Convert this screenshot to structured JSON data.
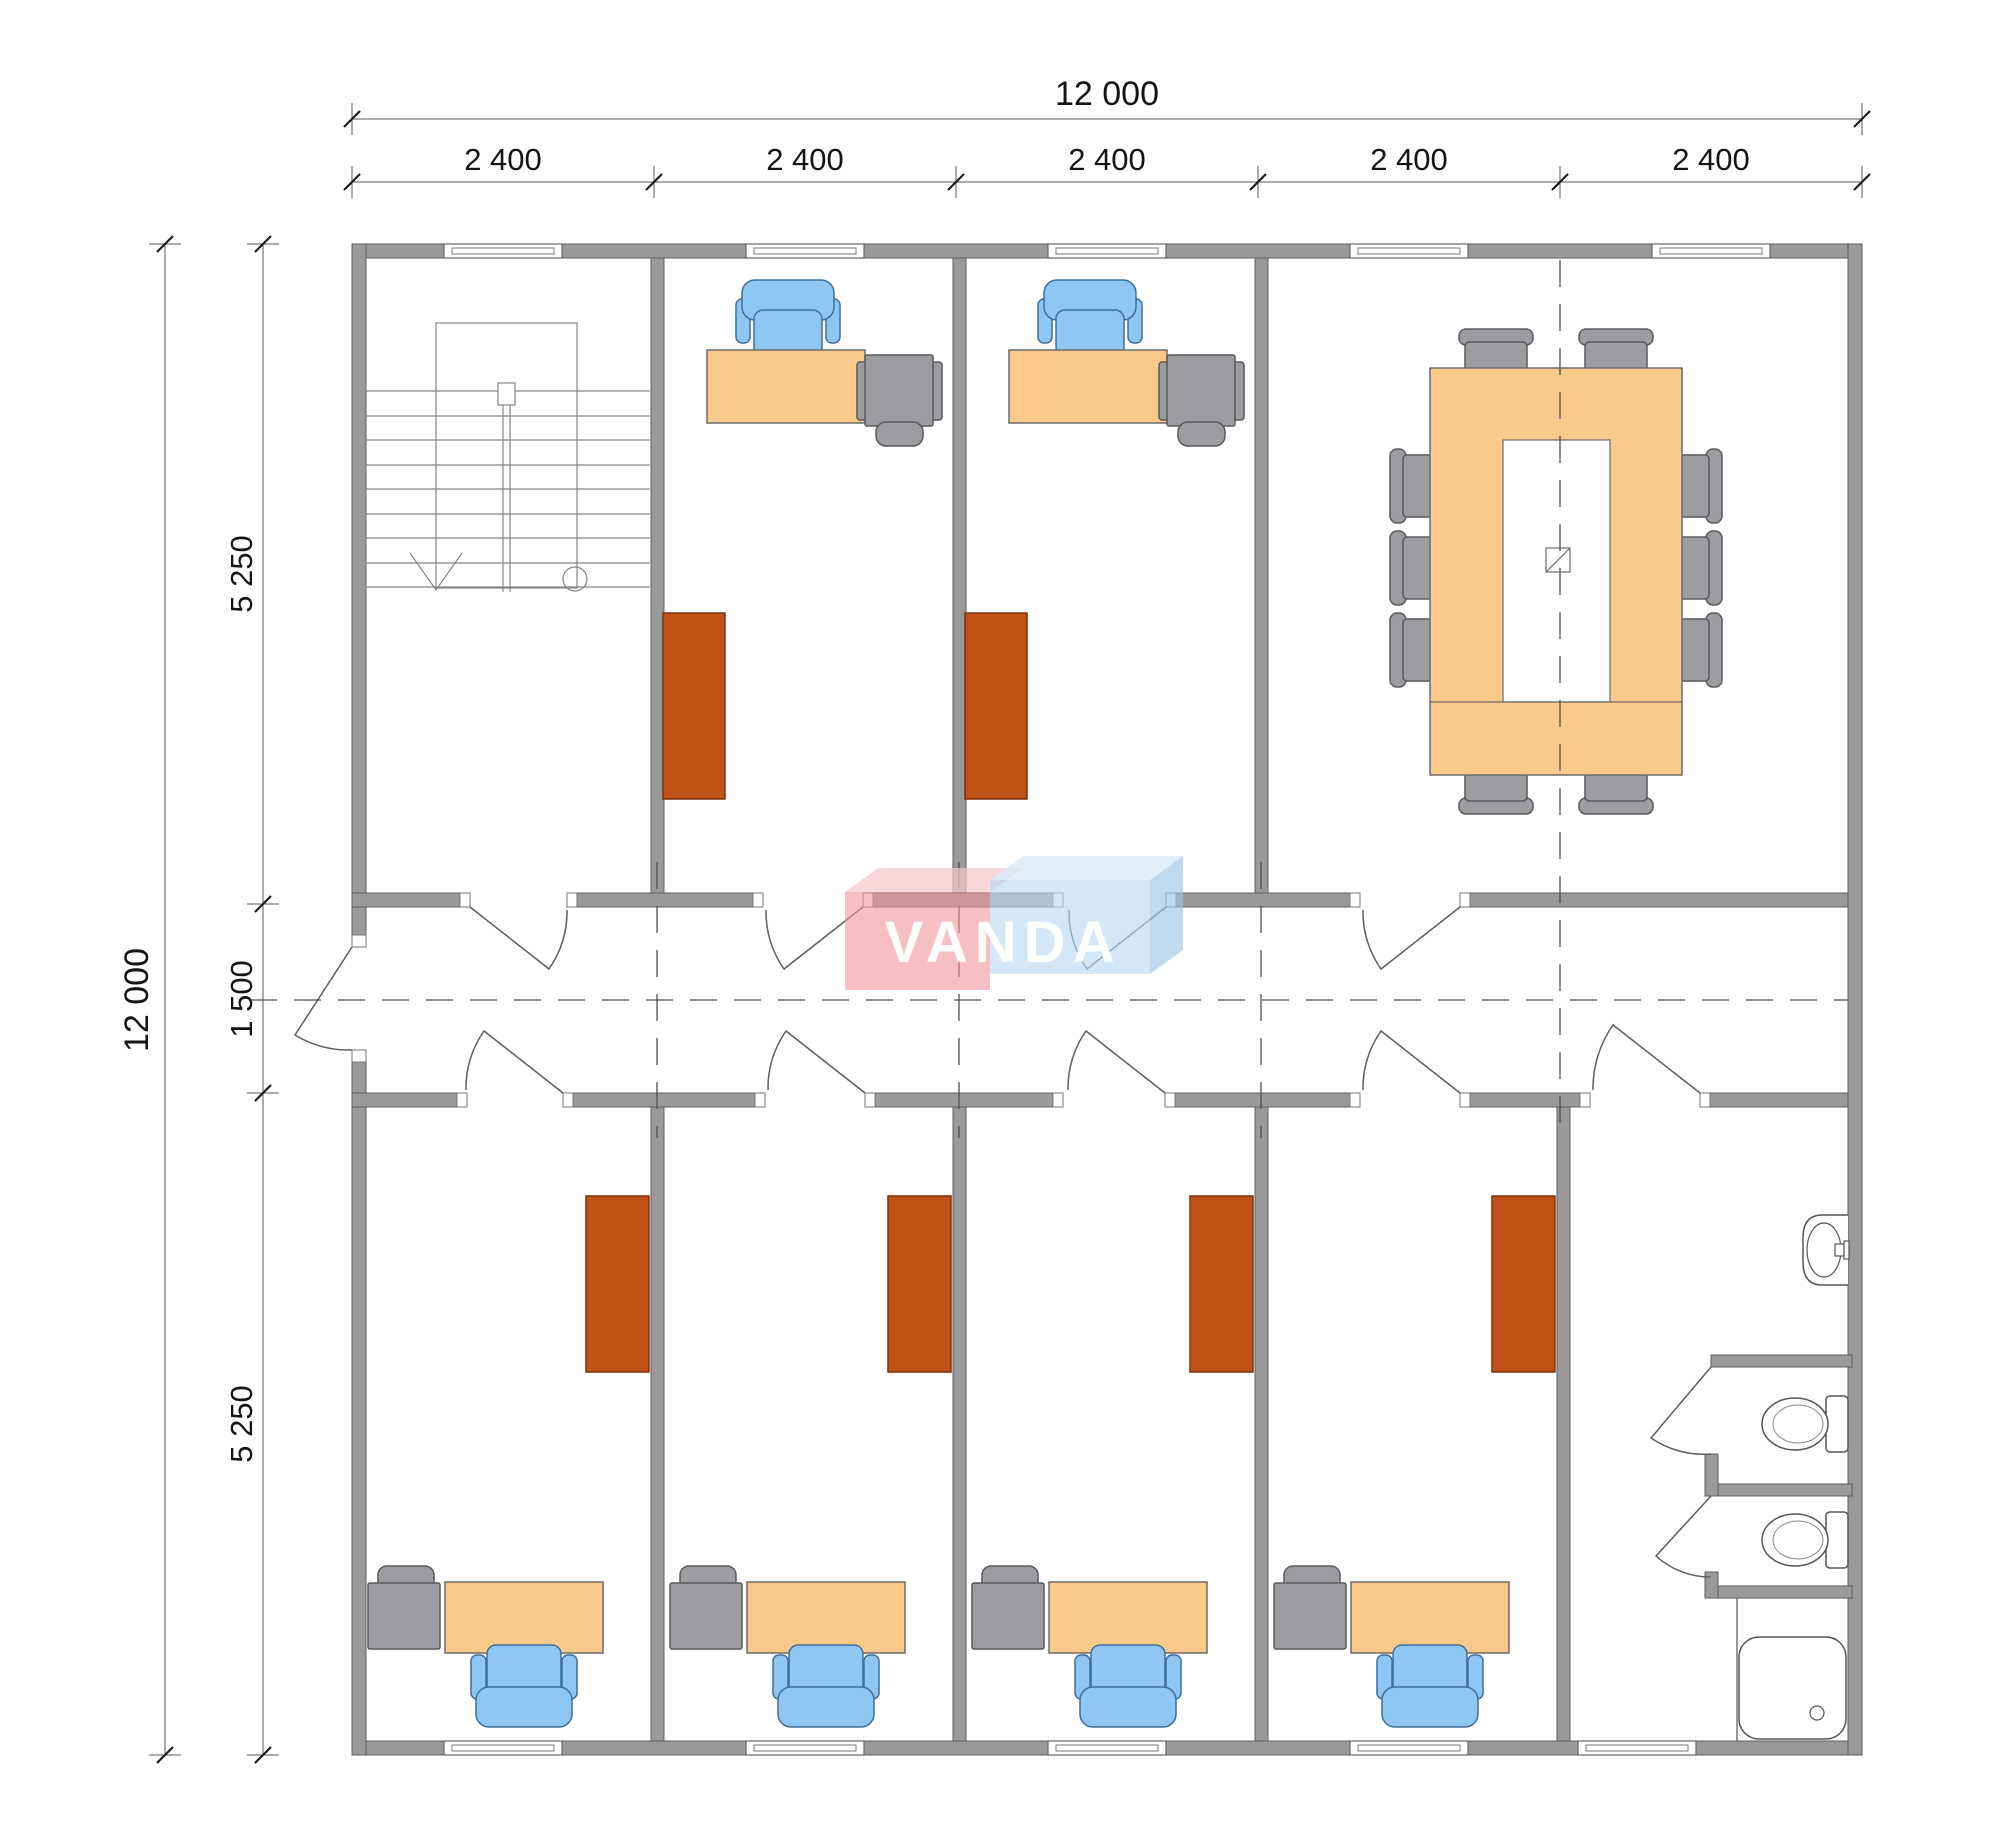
{
  "dimensions": {
    "top_total": "12 000",
    "top_bays": [
      "2 400",
      "2 400",
      "2 400",
      "2 400",
      "2 400"
    ],
    "left_total": "12 000",
    "left_segments": [
      "5 250",
      "1 500",
      "5 250"
    ]
  },
  "logo": {
    "text": "VANDA"
  },
  "colors": {
    "wall": "#9a9a9a",
    "desk": "#fbca8b",
    "chair_blue": "#8ec6f4",
    "furniture_gray": "#9b9da0",
    "cabinet_brown": "#c05117",
    "logo_pink": "#f4b2b8",
    "logo_blue": "#bcdbf2"
  }
}
